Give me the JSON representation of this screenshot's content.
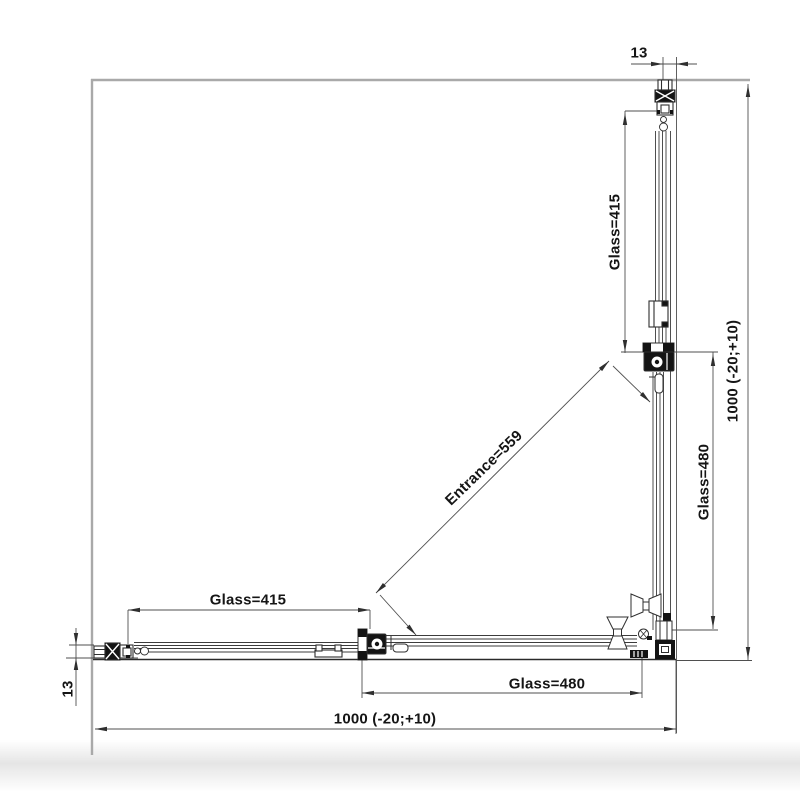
{
  "drawing": {
    "dimensions": {
      "top_thickness": "13",
      "left_thickness": "13",
      "right_total": "1000 (-20;+10)",
      "bottom_total": "1000 (-20;+10)",
      "right_fixed_glass": "Glass=415",
      "right_door_glass": "Glass=480",
      "bottom_fixed_glass": "Glass=415",
      "bottom_door_glass": "Glass=480",
      "entrance": "Entrance=559"
    },
    "colors": {
      "line": "#2f2f2f",
      "wall_line": "#a9a9a9",
      "background": "#ffffff"
    }
  }
}
